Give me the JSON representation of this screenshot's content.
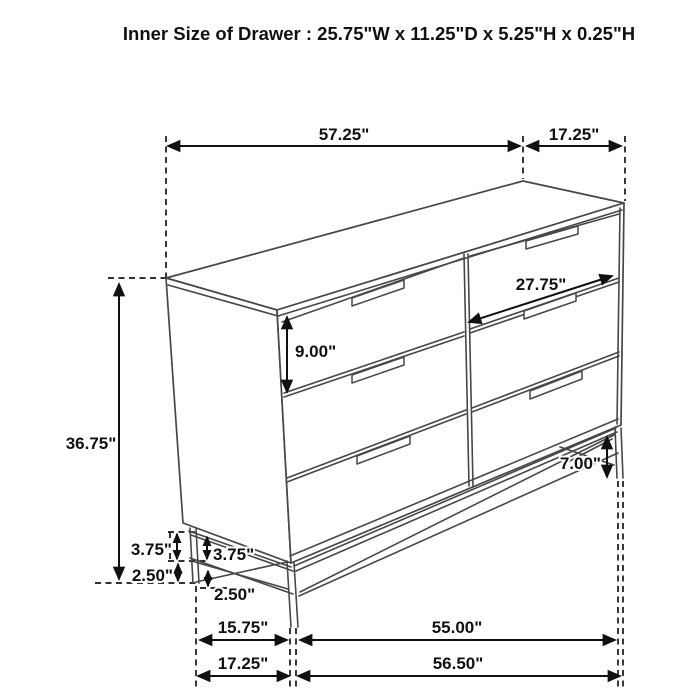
{
  "title": "Inner Size of Drawer : 25.75\"W x 11.25\"D x 5.25\"H x 0.25\"H",
  "diagram": {
    "subject": "six-drawer dresser on metal base",
    "style": "isometric black line drawing with dimension annotations",
    "line_color": "#474747",
    "dimension_color": "#111111",
    "background": "#ffffff"
  },
  "dimensions": {
    "top_width": "57.25\"",
    "top_depth": "17.25\"",
    "overall_height": "36.75\"",
    "drawer_front_height": "9.00\"",
    "drawer_width": "27.75\"",
    "base_height_right": "7.00\"",
    "base_rail_height_rear": "3.75\"",
    "base_clearance_rear": "2.50\"",
    "base_rail_height_front": "3.75\"",
    "base_clearance_front": "2.50\"",
    "base_depth": "15.75\"",
    "base_width": "55.00\"",
    "floor_depth": "17.25\"",
    "floor_width": "56.50\""
  }
}
